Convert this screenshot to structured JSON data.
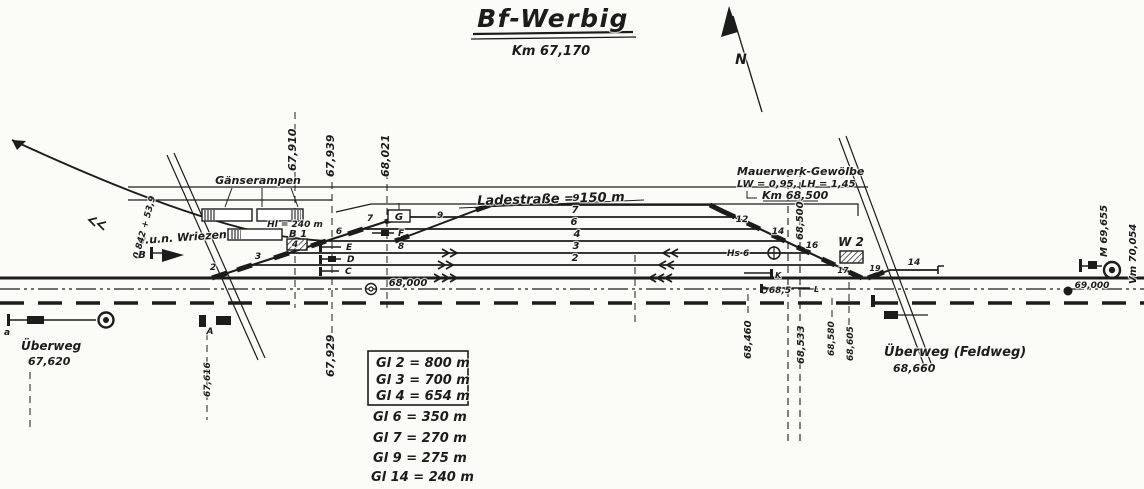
{
  "document": {
    "type_hint": "railway station track plan (scanned hand drawing)",
    "colors": {
      "ink": "#1c1c1c",
      "paper": "#fbfbf8"
    }
  },
  "labels": [
    {
      "id": "title",
      "text": "Bf-Werbig"
    },
    {
      "id": "subtitle",
      "text": "Km 67,170"
    },
    {
      "id": "north",
      "text": "N"
    },
    {
      "id": "gaenserampen",
      "text": "Gänserampen"
    },
    {
      "id": "ramp-length",
      "text": "Hl = 240 m"
    },
    {
      "id": "b1",
      "text": "B 1"
    },
    {
      "id": "g-building",
      "text": "G"
    },
    {
      "id": "wriezen",
      "text": "v.u.n. Wriezen"
    },
    {
      "id": "gradient",
      "text": "0,842 + 53,9"
    },
    {
      "id": "sig-b",
      "text": "B"
    },
    {
      "id": "ladestrasse",
      "text": "Ladestraße = 150 m"
    },
    {
      "id": "km-67910",
      "text": "67,910"
    },
    {
      "id": "km-67939",
      "text": "67,939"
    },
    {
      "id": "km-68021",
      "text": "68,021"
    },
    {
      "id": "km-67929",
      "text": "67,929"
    },
    {
      "id": "culvert-1",
      "text": "Mauerwerk-Gewölbe"
    },
    {
      "id": "culvert-2",
      "text": "LW = 0,95, LH = 1,45"
    },
    {
      "id": "culvert-3",
      "text": "Km 68,500"
    },
    {
      "id": "km-68500-v",
      "text": "68,500"
    },
    {
      "id": "sig-hs6",
      "text": "Hs 6"
    },
    {
      "id": "w2",
      "text": "W 2"
    },
    {
      "id": "gl-9",
      "text": "9"
    },
    {
      "id": "gl-7",
      "text": "7"
    },
    {
      "id": "gl-6",
      "text": "6"
    },
    {
      "id": "gl-4",
      "text": "4"
    },
    {
      "id": "gl-3",
      "text": "3"
    },
    {
      "id": "gl-2",
      "text": "2"
    },
    {
      "id": "gl-14",
      "text": "14"
    },
    {
      "id": "sw-2",
      "text": "2"
    },
    {
      "id": "sw-3",
      "text": "3"
    },
    {
      "id": "sw-4",
      "text": "4"
    },
    {
      "id": "sw-6",
      "text": "6"
    },
    {
      "id": "sw-7",
      "text": "7"
    },
    {
      "id": "sw-8",
      "text": "8"
    },
    {
      "id": "sw-9",
      "text": "9"
    },
    {
      "id": "sw-12",
      "text": "12"
    },
    {
      "id": "sw-14",
      "text": "14"
    },
    {
      "id": "sw-16",
      "text": "16"
    },
    {
      "id": "sw-17",
      "text": "17"
    },
    {
      "id": "sw-19",
      "text": "19"
    },
    {
      "id": "stub-e",
      "text": "E"
    },
    {
      "id": "stub-d",
      "text": "D"
    },
    {
      "id": "stub-c",
      "text": "C"
    },
    {
      "id": "stub-f",
      "text": "F"
    },
    {
      "id": "stub-k",
      "text": "K"
    },
    {
      "id": "stub-l",
      "text": "L"
    },
    {
      "id": "mark-68000",
      "text": "68,000"
    },
    {
      "id": "mark-685",
      "text": "68,5"
    },
    {
      "id": "mark-69000",
      "text": "69,000"
    },
    {
      "id": "v-68460",
      "text": "68,460"
    },
    {
      "id": "v-68533",
      "text": "68,533"
    },
    {
      "id": "v-68580",
      "text": "68,580"
    },
    {
      "id": "v-68605",
      "text": "68,605"
    },
    {
      "id": "uw-west",
      "text": "Überweg"
    },
    {
      "id": "uw-west-km",
      "text": "67,620"
    },
    {
      "id": "v-67616",
      "text": "67,616"
    },
    {
      "id": "sig-a-cap",
      "text": "A"
    },
    {
      "id": "sig-a",
      "text": "a"
    },
    {
      "id": "uw-east",
      "text": "Überweg (Feldweg)"
    },
    {
      "id": "uw-east-km",
      "text": "68,660"
    },
    {
      "id": "v-m",
      "text": "M  69,655"
    },
    {
      "id": "v-vm",
      "text": "Vm  70,054"
    },
    {
      "id": "legend-1",
      "text": "Gl 2 = 800 m"
    },
    {
      "id": "legend-2",
      "text": "Gl 3 = 700 m"
    },
    {
      "id": "legend-3",
      "text": "Gl 4 = 654 m"
    },
    {
      "id": "legend-4",
      "text": "Gl 6 = 350 m"
    },
    {
      "id": "legend-5",
      "text": "Gl 7 = 270 m"
    },
    {
      "id": "legend-6",
      "text": "Gl 9 = 275 m"
    },
    {
      "id": "legend-7",
      "text": "Gl 14 = 240 m"
    }
  ]
}
